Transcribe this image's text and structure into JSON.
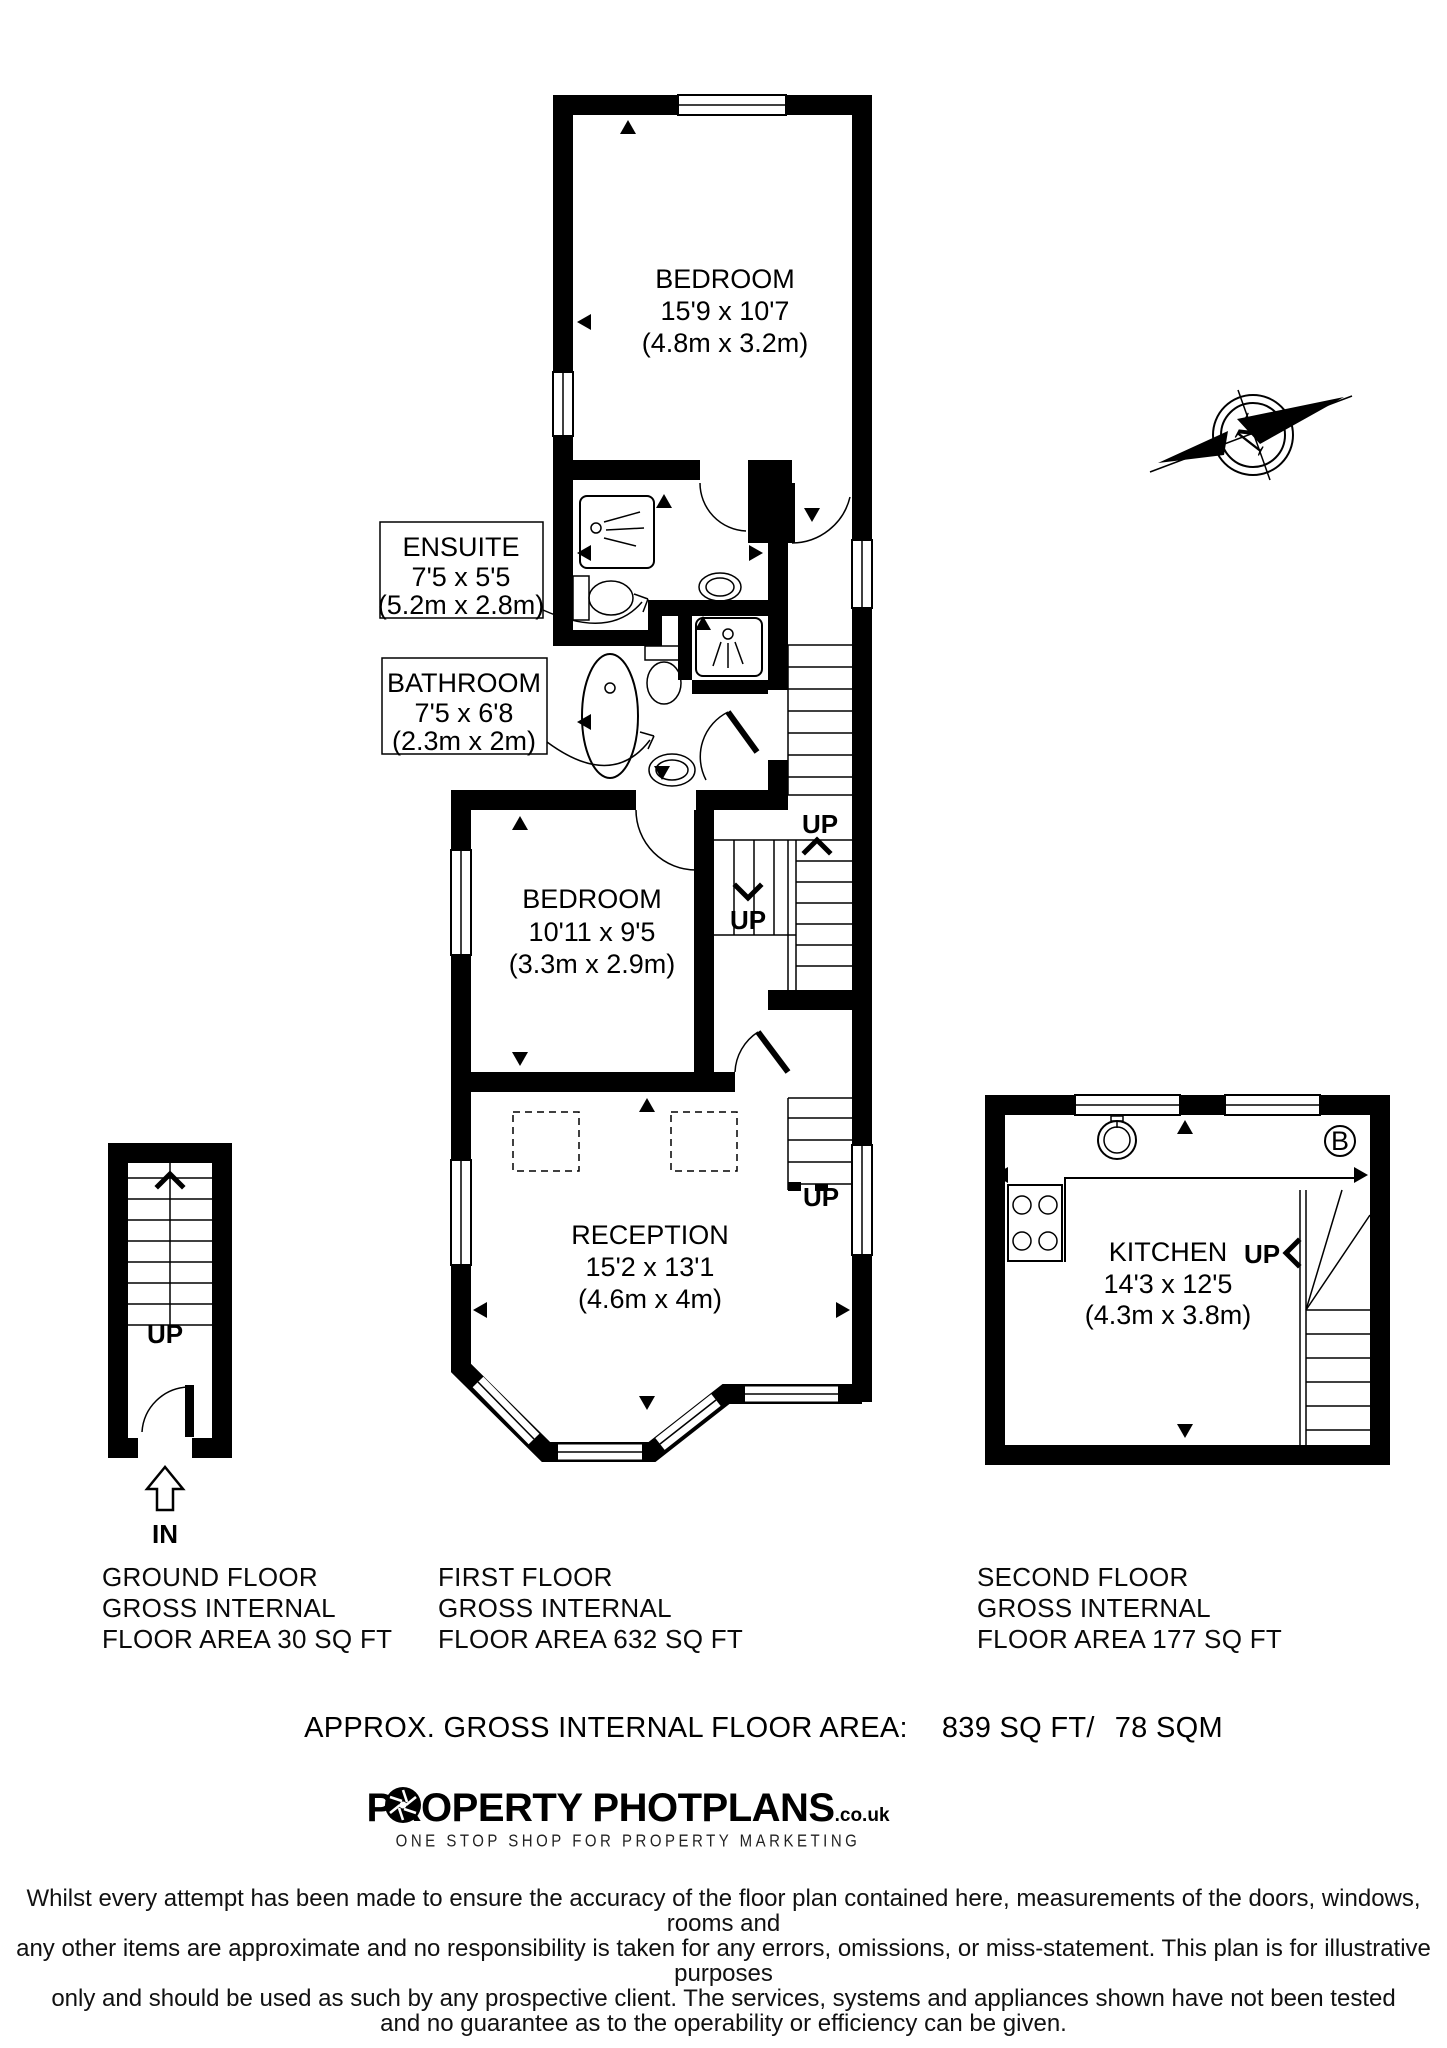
{
  "compass": {
    "north_label": "N"
  },
  "rooms": [
    {
      "name": "BEDROOM",
      "imperial": "15'9 x 10'7",
      "metric": "(4.8m x 3.2m)"
    },
    {
      "name": "ENSUITE",
      "imperial": "7'5 x 5'5",
      "metric": "(5.2m x 2.8m)"
    },
    {
      "name": "BATHROOM",
      "imperial": "7'5 x 6'8",
      "metric": "(2.3m x 2m)"
    },
    {
      "name": "BEDROOM",
      "imperial": "10'11 x 9'5",
      "metric": "(3.3m x 2.9m)"
    },
    {
      "name": "RECEPTION",
      "imperial": "15'2 x 13'1",
      "metric": "(4.6m x 4m)"
    },
    {
      "name": "KITCHEN",
      "imperial": "14'3 x 12'5",
      "metric": "(4.3m x 3.8m)"
    }
  ],
  "markers": {
    "up_label": "UP",
    "in_label": "IN",
    "boiler_label": "B"
  },
  "floors": [
    {
      "lines": [
        "GROUND FLOOR",
        "GROSS INTERNAL",
        "FLOOR AREA 30 SQ FT"
      ]
    },
    {
      "lines": [
        "FIRST FLOOR",
        "GROSS INTERNAL",
        "FLOOR AREA 632 SQ FT"
      ]
    },
    {
      "lines": [
        "SECOND FLOOR",
        "GROSS INTERNAL",
        "FLOOR AREA 177 SQ FT"
      ]
    }
  ],
  "total": {
    "label": "APPROX. GROSS INTERNAL FLOOR AREA:",
    "sqft": "839 SQ FT/",
    "sqm": "78 SQM"
  },
  "logo": {
    "part1": "PROPERTY PHOT",
    "part2": "PLANS",
    "suffix": ".co.uk",
    "tagline": "ONE STOP SHOP FOR PROPERTY MARKETING"
  },
  "disclaimer_lines": [
    "Whilst every attempt has been made to ensure the accuracy of the floor plan contained here, measurements of the doors, windows, rooms and",
    "any other items are approximate and no responsibility is taken for any errors, omissions, or miss-statement. This plan is for illustrative purposes",
    "only and should be used as such by any prospective client. The services, systems and appliances shown have not been tested",
    "and no guarantee as to the operability or efficiency can be given."
  ],
  "colors": {
    "wall": "#000000",
    "paper": "#ffffff"
  }
}
